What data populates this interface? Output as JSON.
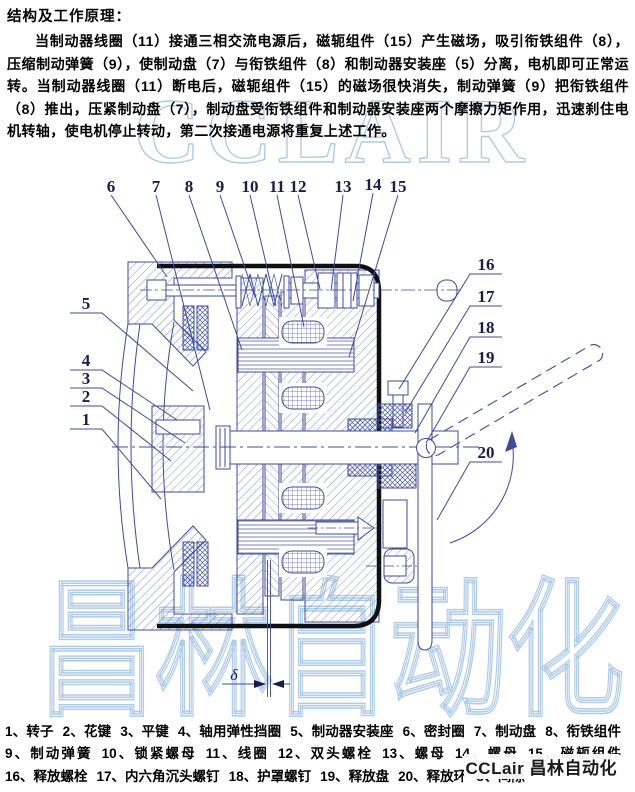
{
  "document": {
    "title": "结构及工作原理：",
    "paragraph": "当制动器线圈（11）接通三相交流电源后，磁轭组件（15）产生磁场，吸引衔铁组件（8），压缩制动弹簧（9），使制动盘（7）与衔铁组件（8）和制动器安装座（5）分离，电机即可正常运转。当制动器线圈（11）断电后，磁轭组件（15）的磁场很快消失，制动弹簧（9）把衔铁组件（8）推出，压紧制动盘（7），制动盘受衔铁组件和制动器安装座两个摩擦力矩作用，迅速刹住电机转轴，使电机停止转动，第二次接通电源将重复上述工作。"
  },
  "watermarks": {
    "top": "CCLAIR",
    "bottom": "昌林自动化",
    "corner": "CCLair 昌林自动化"
  },
  "diagram": {
    "description": "电磁制动器剖视图",
    "delta_label": "δ",
    "callouts": [
      {
        "label": "6",
        "x": 111,
        "y": 192,
        "tx": 167,
        "ty": 277,
        "side": "top"
      },
      {
        "label": "7",
        "x": 156,
        "y": 192,
        "tx": 210,
        "ty": 410,
        "side": "top"
      },
      {
        "label": "8",
        "x": 189,
        "y": 192,
        "tx": 242,
        "ty": 350,
        "side": "top"
      },
      {
        "label": "9",
        "x": 220,
        "y": 192,
        "tx": 255,
        "ty": 297,
        "side": "top"
      },
      {
        "label": "10",
        "x": 250,
        "y": 192,
        "tx": 276,
        "ty": 306,
        "side": "top"
      },
      {
        "label": "11",
        "x": 277,
        "y": 192,
        "tx": 304,
        "ty": 327,
        "side": "top"
      },
      {
        "label": "12",
        "x": 298,
        "y": 192,
        "tx": 320,
        "ty": 289,
        "side": "top"
      },
      {
        "label": "13",
        "x": 343,
        "y": 192,
        "tx": 331,
        "ty": 291,
        "side": "top"
      },
      {
        "label": "14",
        "x": 373,
        "y": 190,
        "tx": 353,
        "ty": 301,
        "side": "top"
      },
      {
        "label": "15",
        "x": 398,
        "y": 192,
        "tx": 349,
        "ty": 357,
        "side": "top"
      },
      {
        "label": "5",
        "x": 86,
        "y": 309,
        "tx": 193,
        "ty": 391,
        "side": "left"
      },
      {
        "label": "4",
        "x": 86,
        "y": 366,
        "tx": 177,
        "ty": 420,
        "side": "left"
      },
      {
        "label": "3",
        "x": 86,
        "y": 384,
        "tx": 185,
        "ty": 443,
        "side": "left"
      },
      {
        "label": "2",
        "x": 86,
        "y": 402,
        "tx": 171,
        "ty": 461,
        "side": "left"
      },
      {
        "label": "1",
        "x": 86,
        "y": 425,
        "tx": 161,
        "ty": 499,
        "side": "left"
      },
      {
        "label": "16",
        "x": 486,
        "y": 270,
        "tx": 399,
        "ty": 389,
        "side": "right"
      },
      {
        "label": "17",
        "x": 486,
        "y": 302,
        "tx": 405,
        "ty": 413,
        "side": "right"
      },
      {
        "label": "18",
        "x": 486,
        "y": 333,
        "tx": 415,
        "ty": 433,
        "side": "right"
      },
      {
        "label": "19",
        "x": 486,
        "y": 363,
        "tx": 426,
        "ty": 443,
        "side": "right"
      },
      {
        "label": "20",
        "x": 486,
        "y": 458,
        "tx": 437,
        "ty": 520,
        "side": "right"
      }
    ]
  },
  "parts": [
    {
      "no": "1",
      "name": "转子"
    },
    {
      "no": "2",
      "name": "花键"
    },
    {
      "no": "3",
      "name": "平键"
    },
    {
      "no": "4",
      "name": "轴用弹性挡圈"
    },
    {
      "no": "5",
      "name": "制动器安装座"
    },
    {
      "no": "6",
      "name": "密封圈"
    },
    {
      "no": "7",
      "name": "制动盘"
    },
    {
      "no": "8",
      "name": "衔铁组件"
    },
    {
      "no": "9",
      "name": "制动弹簧"
    },
    {
      "no": "10",
      "name": "锁紧螺母"
    },
    {
      "no": "11",
      "name": "线圈"
    },
    {
      "no": "12",
      "name": "双头螺栓"
    },
    {
      "no": "13",
      "name": "螺母"
    },
    {
      "no": "14",
      "name": "螺母"
    },
    {
      "no": "15",
      "name": "磁轭组件"
    },
    {
      "no": "16",
      "name": "释放螺栓"
    },
    {
      "no": "17",
      "name": "内六角沉头螺钉"
    },
    {
      "no": "18",
      "name": "护罩螺钉"
    },
    {
      "no": "19",
      "name": "释放盘"
    },
    {
      "no": "20",
      "name": "释放环"
    },
    {
      "no": "δ",
      "name": "间隙"
    }
  ],
  "colors": {
    "line_blue": "#3d4b9c",
    "hatch_blue": "#6473b8",
    "outline_black": "#101010",
    "watermark_blue": "#aecbe8",
    "callout_ink": "#1c1c4a"
  }
}
